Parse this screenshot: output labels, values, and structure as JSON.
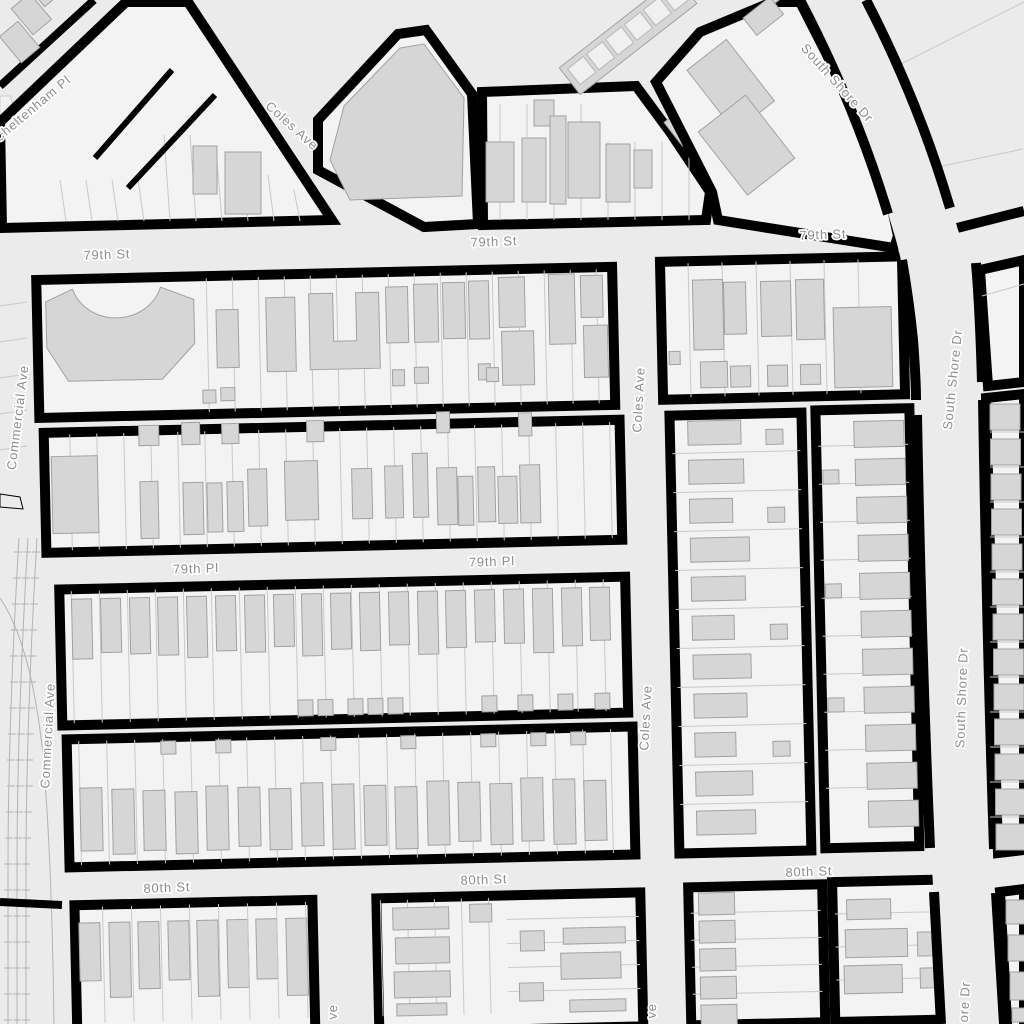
{
  "map": {
    "colors": {
      "street": "#ebebeb",
      "block": "#f3f3f3",
      "building": "#d6d6d6",
      "bstroke": "#a2a2a2",
      "border": "#000000",
      "lot": "#c9c9c9",
      "label": "#8d8d8d",
      "halo": "#ffffff",
      "rail": "#b3b3b3"
    },
    "street_labels": [
      {
        "text": "Cheltenham Pl",
        "x": 35,
        "y": 112,
        "rot": -40
      },
      {
        "text": "Coles Ave",
        "x": 289,
        "y": 129,
        "rot": 42
      },
      {
        "text": "South Shore Dr",
        "x": 834,
        "y": 86,
        "rot": 48
      },
      {
        "text": "79th St",
        "x": 107,
        "y": 259,
        "rot": -2
      },
      {
        "text": "79th St",
        "x": 494,
        "y": 246,
        "rot": -2
      },
      {
        "text": "79th St",
        "x": 823,
        "y": 239,
        "rot": -2
      },
      {
        "text": "Commercial Ave",
        "x": 22,
        "y": 418,
        "rot": -83
      },
      {
        "text": "Commercial Ave",
        "x": 52,
        "y": 736,
        "rot": -87
      },
      {
        "text": "79th Pl",
        "x": 196,
        "y": 573,
        "rot": -2
      },
      {
        "text": "79th Pl",
        "x": 492,
        "y": 566,
        "rot": -2
      },
      {
        "text": "Coles Ave",
        "x": 643,
        "y": 400,
        "rot": -87
      },
      {
        "text": "Coles Ave",
        "x": 650,
        "y": 718,
        "rot": -87
      },
      {
        "text": "South Shore Dr",
        "x": 957,
        "y": 380,
        "rot": -84
      },
      {
        "text": "South Shore Dr",
        "x": 966,
        "y": 698,
        "rot": -88
      },
      {
        "text": "80th St",
        "x": 167,
        "y": 892,
        "rot": -2
      },
      {
        "text": "80th St",
        "x": 484,
        "y": 884,
        "rot": -2
      },
      {
        "text": "80th St",
        "x": 809,
        "y": 876,
        "rot": -2
      },
      {
        "text": "ve",
        "x": 337,
        "y": 1012,
        "rot": -88
      },
      {
        "text": "ve",
        "x": 656,
        "y": 1011,
        "rot": -88
      },
      {
        "text": "ore Dr",
        "x": 969,
        "y": 1002,
        "rot": -87
      }
    ]
  }
}
